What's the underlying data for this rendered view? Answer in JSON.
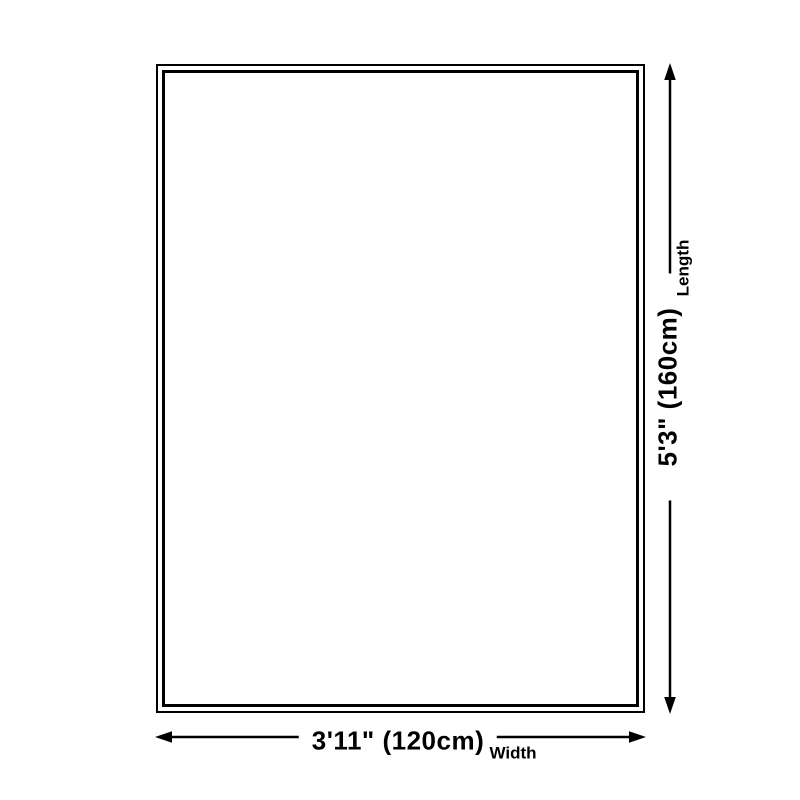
{
  "diagram": {
    "background_color": "#ffffff",
    "line_color": "#000000",
    "length": {
      "value": "5'3\" (160cm)",
      "label": "Length"
    },
    "width": {
      "value": "3'11\" (120cm)",
      "label": "Width"
    }
  }
}
